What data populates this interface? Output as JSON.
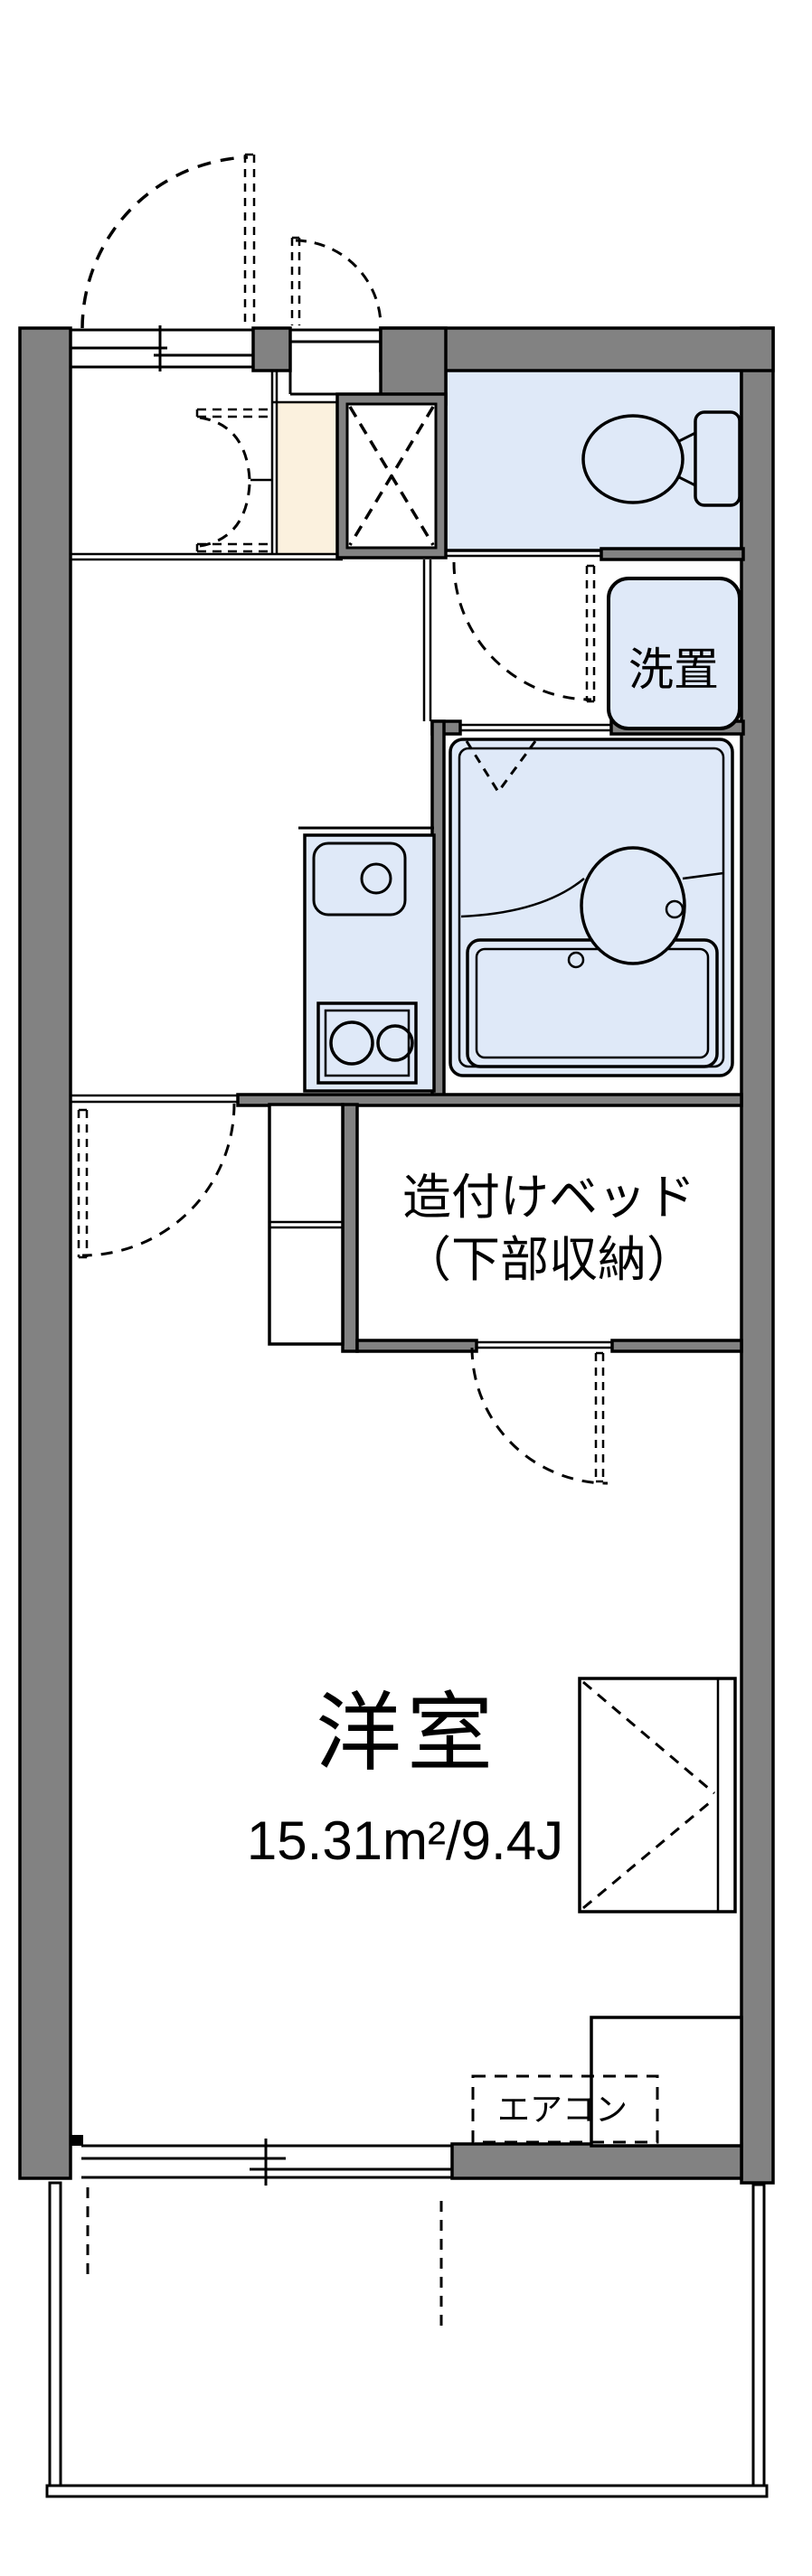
{
  "plan": {
    "type": "apartment-floorplan",
    "labels": {
      "main_room": {
        "name": "洋室",
        "area": "15.31m²/9.4J"
      },
      "bed": {
        "line1": "造付けベッド",
        "line2": "（下部収納）"
      },
      "washer": "洗置",
      "aircon": "エアコン"
    },
    "colors": {
      "wall_gray": "#828282",
      "fixture_blue": "#dfe9f8",
      "genkan_beige": "#fbf1de",
      "line_black": "#000000",
      "background": "#ffffff"
    },
    "rooms": [
      {
        "id": "western-room",
        "label": "洋室",
        "area": "15.31m²/9.4J"
      },
      {
        "id": "built-in-bed",
        "label": "造付けベッド（下部収納）"
      },
      {
        "id": "toilet",
        "label": ""
      },
      {
        "id": "washer-space",
        "label": "洗置"
      },
      {
        "id": "bathroom",
        "label": ""
      },
      {
        "id": "kitchen",
        "label": ""
      },
      {
        "id": "balcony",
        "label": ""
      },
      {
        "id": "aircon-slot",
        "label": "エアコン"
      }
    ]
  }
}
